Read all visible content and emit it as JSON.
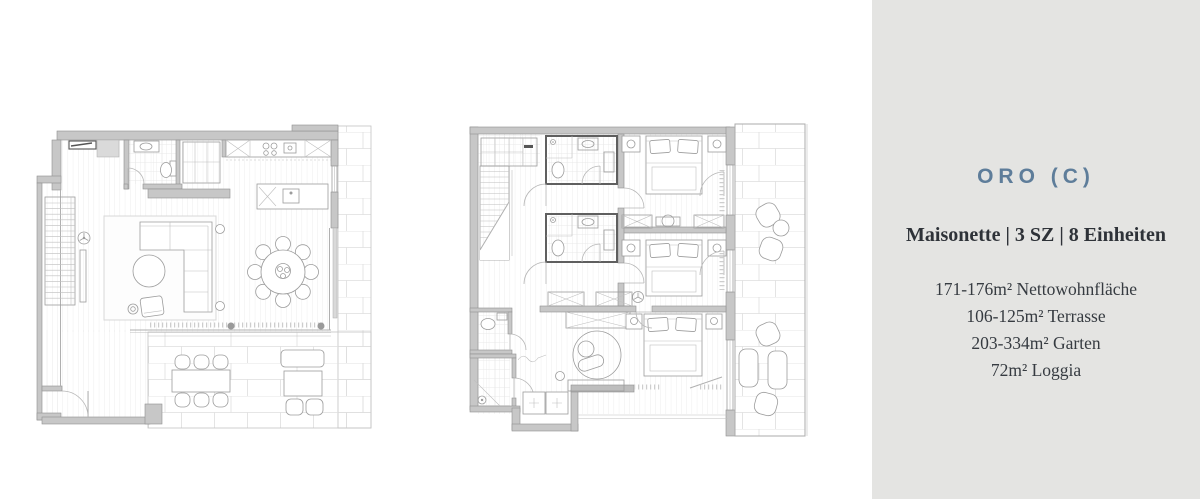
{
  "panel": {
    "title": "ORO (C)",
    "subtitle": "Maisonette | 3 SZ | 8 Einheiten",
    "details": [
      "171-176m² Nettowohnfläche",
      "106-125m² Terrasse",
      "203-334m² Garten",
      "72m² Loggia"
    ],
    "colors": {
      "background": "#e4e4e2",
      "title": "#5e7d9a",
      "text": "#363b41"
    }
  },
  "plans": {
    "left_icon": "lower-floor-plan",
    "right_icon": "upper-floor-plan"
  }
}
